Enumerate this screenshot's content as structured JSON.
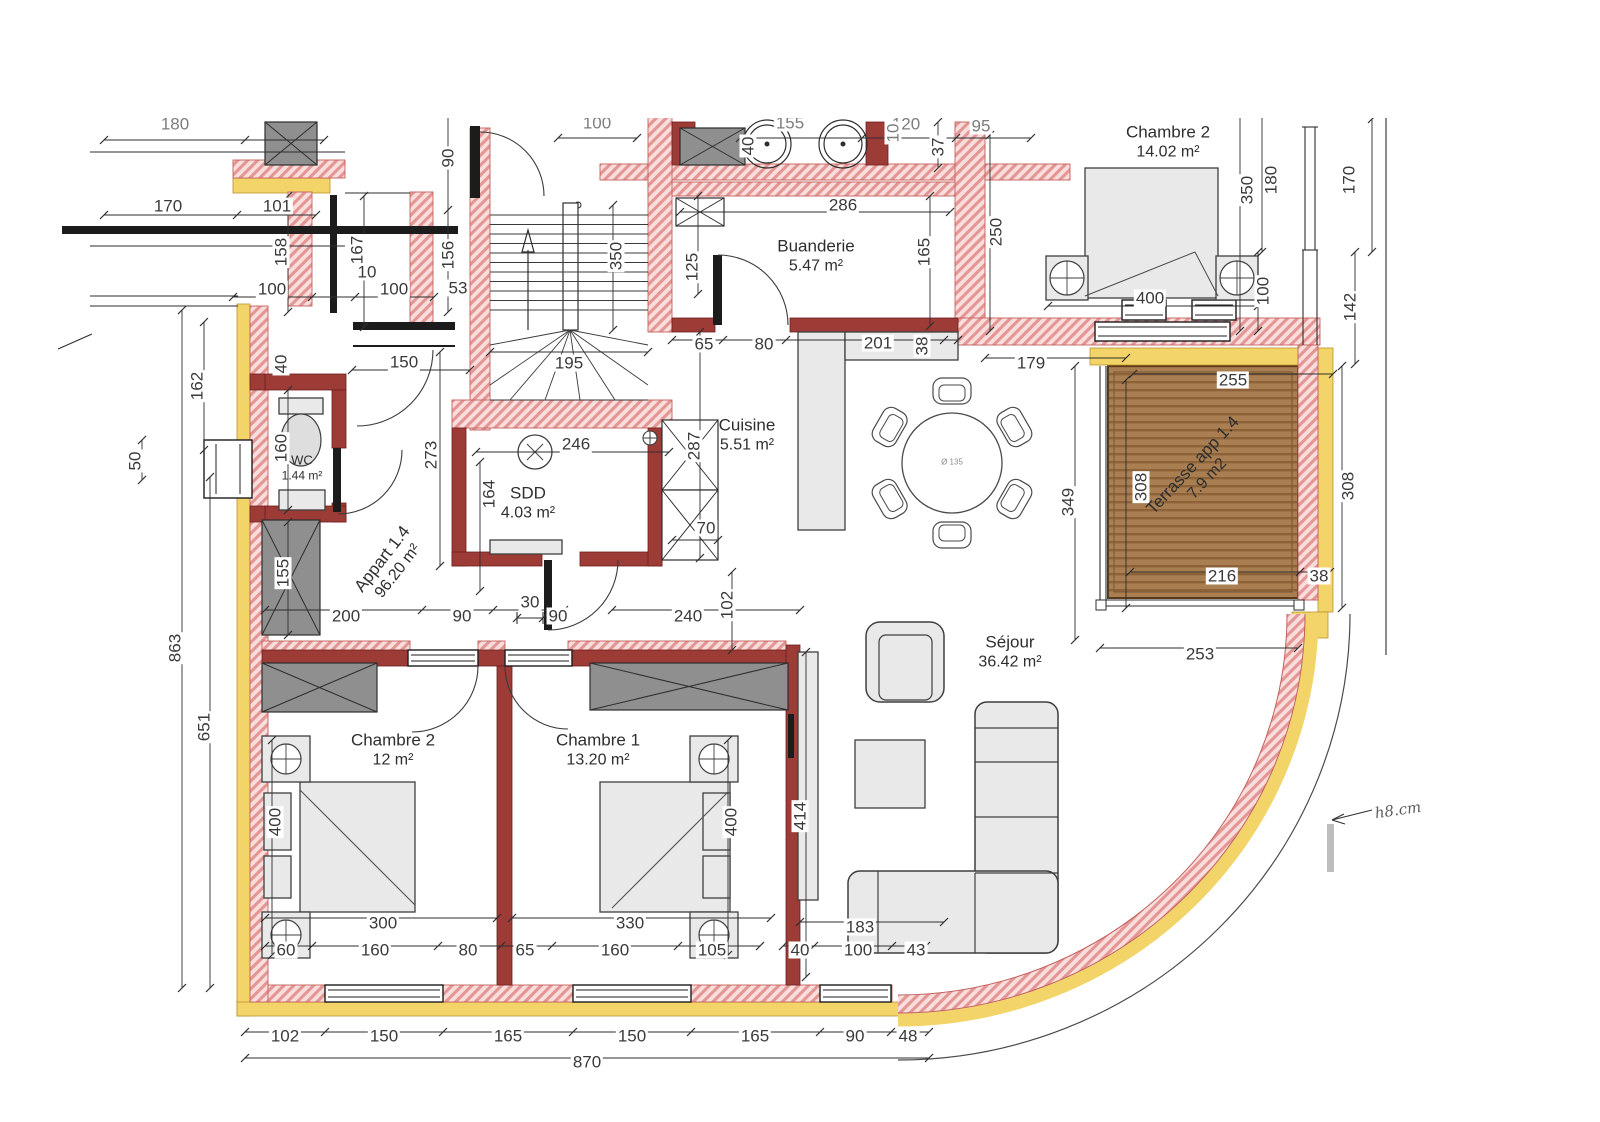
{
  "plan_title": "Appart 1.4 floor plan",
  "colors": {
    "wall_hatch_pink": "#e39693",
    "wall_interior_red": "#9d3b36",
    "facade_yellow": "#f2d468",
    "terrace_brown": "#a97f52",
    "text": "#3a3a3a"
  },
  "rooms": [
    {
      "name": "Chambre 2",
      "area": "14.02 m²",
      "x": 1168,
      "y": 142,
      "r": 0
    },
    {
      "name": "Buanderie",
      "area": "5.47 m²",
      "x": 816,
      "y": 256,
      "r": 0
    },
    {
      "name": "Cuisine",
      "area": "5.51 m²",
      "x": 747,
      "y": 435,
      "r": 0
    },
    {
      "name": "WC",
      "area": "1.44 m²",
      "x": 302,
      "y": 468,
      "r": 0,
      "small": true
    },
    {
      "name": "SDD",
      "area": "4.03 m²",
      "x": 528,
      "y": 503,
      "r": 0
    },
    {
      "name": "Appart 1.4",
      "area": "96.20 m²",
      "x": 390,
      "y": 565,
      "r": -52
    },
    {
      "name": "Terrasse app 1.4",
      "area": "7.9 m2",
      "x": 1200,
      "y": 472,
      "r": -47
    },
    {
      "name": "Séjour",
      "area": "36.42 m²",
      "x": 1010,
      "y": 652,
      "r": 0
    },
    {
      "name": "Chambre 2",
      "area": "12 m²",
      "x": 393,
      "y": 750,
      "r": 0
    },
    {
      "name": "Chambre 1",
      "area": "13.20 m²",
      "x": 598,
      "y": 750,
      "r": 0
    }
  ],
  "dims": [
    {
      "t": "180",
      "x": 175,
      "y": 124,
      "cut": 1
    },
    {
      "t": "100",
      "x": 597,
      "y": 123,
      "cut": 1
    },
    {
      "t": "155",
      "x": 790,
      "y": 123,
      "cut": 1
    },
    {
      "t": "120",
      "x": 906,
      "y": 124,
      "cut": 1
    },
    {
      "t": "95",
      "x": 981,
      "y": 126,
      "cut": 1
    },
    {
      "t": "40",
      "x": 748,
      "y": 146,
      "r": -90
    },
    {
      "t": "37",
      "x": 938,
      "y": 147,
      "r": -90
    },
    {
      "t": "10",
      "x": 893,
      "y": 133,
      "r": -90,
      "cut": 1
    },
    {
      "t": "170",
      "x": 168,
      "y": 206
    },
    {
      "t": "101",
      "x": 277,
      "y": 206
    },
    {
      "t": "158",
      "x": 281,
      "y": 252,
      "r": -90
    },
    {
      "t": "167",
      "x": 357,
      "y": 250,
      "r": -90
    },
    {
      "t": "10",
      "x": 367,
      "y": 272
    },
    {
      "t": "100",
      "x": 272,
      "y": 289
    },
    {
      "t": "100",
      "x": 394,
      "y": 289
    },
    {
      "t": "90",
      "x": 448,
      "y": 158,
      "r": -90
    },
    {
      "t": "156",
      "x": 448,
      "y": 255,
      "r": -90
    },
    {
      "t": "53",
      "x": 458,
      "y": 288
    },
    {
      "t": "150",
      "x": 404,
      "y": 362
    },
    {
      "t": "40",
      "x": 281,
      "y": 364,
      "r": -90
    },
    {
      "t": "162",
      "x": 197,
      "y": 386,
      "r": -90
    },
    {
      "t": "50",
      "x": 135,
      "y": 461,
      "r": -90
    },
    {
      "t": "160",
      "x": 281,
      "y": 448,
      "r": -90
    },
    {
      "t": "155",
      "x": 283,
      "y": 573,
      "r": -90
    },
    {
      "t": "863",
      "x": 175,
      "y": 648,
      "r": -90
    },
    {
      "t": "651",
      "x": 204,
      "y": 727,
      "r": -90
    },
    {
      "t": "273",
      "x": 431,
      "y": 455,
      "r": -90
    },
    {
      "t": "246",
      "x": 576,
      "y": 444
    },
    {
      "t": "164",
      "x": 489,
      "y": 494,
      "r": -90
    },
    {
      "t": "30",
      "x": 530,
      "y": 602
    },
    {
      "t": "200",
      "x": 346,
      "y": 616
    },
    {
      "t": "90",
      "x": 462,
      "y": 616
    },
    {
      "t": "90",
      "x": 558,
      "y": 616
    },
    {
      "t": "240",
      "x": 688,
      "y": 616
    },
    {
      "t": "102",
      "x": 727,
      "y": 605,
      "r": -90
    },
    {
      "t": "195",
      "x": 569,
      "y": 363
    },
    {
      "t": "350",
      "x": 616,
      "y": 256,
      "r": -90
    },
    {
      "t": "286",
      "x": 843,
      "y": 205
    },
    {
      "t": "165",
      "x": 924,
      "y": 252,
      "r": -90
    },
    {
      "t": "125",
      "x": 692,
      "y": 267,
      "r": -90
    },
    {
      "t": "287",
      "x": 694,
      "y": 446,
      "r": -90
    },
    {
      "t": "65",
      "x": 704,
      "y": 344
    },
    {
      "t": "80",
      "x": 764,
      "y": 344
    },
    {
      "t": "201",
      "x": 878,
      "y": 343
    },
    {
      "t": "38",
      "x": 922,
      "y": 346,
      "r": -90
    },
    {
      "t": "70",
      "x": 706,
      "y": 528
    },
    {
      "t": "250",
      "x": 996,
      "y": 232,
      "r": -90
    },
    {
      "t": "350",
      "x": 1247,
      "y": 190,
      "r": -90
    },
    {
      "t": "180",
      "x": 1271,
      "y": 180,
      "r": -90
    },
    {
      "t": "170",
      "x": 1349,
      "y": 180,
      "r": -90
    },
    {
      "t": "400",
      "x": 1150,
      "y": 298
    },
    {
      "t": "100",
      "x": 1263,
      "y": 291,
      "r": -90
    },
    {
      "t": "142",
      "x": 1350,
      "y": 307,
      "r": -90
    },
    {
      "t": "179",
      "x": 1031,
      "y": 363
    },
    {
      "t": "255",
      "x": 1233,
      "y": 380
    },
    {
      "t": "308",
      "x": 1141,
      "y": 487,
      "r": -90
    },
    {
      "t": "308",
      "x": 1348,
      "y": 486,
      "r": -90
    },
    {
      "t": "216",
      "x": 1222,
      "y": 576
    },
    {
      "t": "38",
      "x": 1319,
      "y": 576
    },
    {
      "t": "253",
      "x": 1200,
      "y": 654
    },
    {
      "t": "349",
      "x": 1068,
      "y": 502,
      "r": -90
    },
    {
      "t": "414",
      "x": 800,
      "y": 816,
      "r": -90
    },
    {
      "t": "183",
      "x": 860,
      "y": 927
    },
    {
      "t": "40",
      "x": 800,
      "y": 950
    },
    {
      "t": "100",
      "x": 858,
      "y": 950
    },
    {
      "t": "43",
      "x": 916,
      "y": 950
    },
    {
      "t": "300",
      "x": 383,
      "y": 923
    },
    {
      "t": "330",
      "x": 630,
      "y": 923
    },
    {
      "t": "60",
      "x": 286,
      "y": 950
    },
    {
      "t": "160",
      "x": 375,
      "y": 950
    },
    {
      "t": "80",
      "x": 468,
      "y": 950
    },
    {
      "t": "65",
      "x": 525,
      "y": 950
    },
    {
      "t": "160",
      "x": 615,
      "y": 950
    },
    {
      "t": "105",
      "x": 712,
      "y": 950
    },
    {
      "t": "400",
      "x": 275,
      "y": 822,
      "r": -90
    },
    {
      "t": "400",
      "x": 731,
      "y": 822,
      "r": -90
    },
    {
      "t": "102",
      "x": 285,
      "y": 1036
    },
    {
      "t": "150",
      "x": 384,
      "y": 1036
    },
    {
      "t": "165",
      "x": 508,
      "y": 1036
    },
    {
      "t": "150",
      "x": 632,
      "y": 1036
    },
    {
      "t": "165",
      "x": 755,
      "y": 1036
    },
    {
      "t": "90",
      "x": 855,
      "y": 1036
    },
    {
      "t": "48",
      "x": 908,
      "y": 1036
    },
    {
      "t": "870",
      "x": 587,
      "y": 1062
    }
  ],
  "annotations": [
    {
      "t": "h8.cm",
      "x": 1398,
      "y": 810,
      "r": -8,
      "hand": true
    },
    {
      "t": "Ø 135",
      "x": 952,
      "y": 462,
      "tiny": true
    }
  ]
}
